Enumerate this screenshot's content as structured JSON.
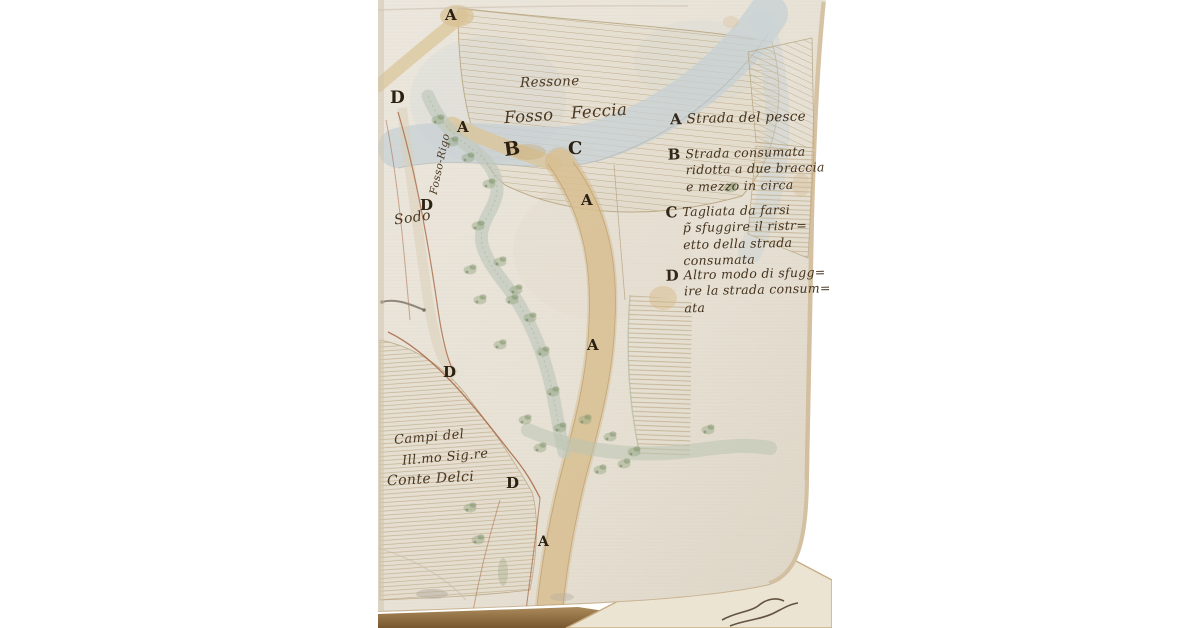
{
  "colors": {
    "background": "#ffffff",
    "paper": "#e8e2d8",
    "page_edge": "#c8aa7c",
    "ink": "#4a3722",
    "letter_ink": "#2b2112",
    "road_wash": "#d9c193",
    "stream_wash": "#c7d0d4",
    "vegetation_green": "#8ea37b",
    "boundary_red": "#a5603c"
  },
  "map_letters": [
    {
      "char": "A"
    },
    {
      "char": "D"
    },
    {
      "char": "A"
    },
    {
      "char": "B"
    },
    {
      "char": "C"
    },
    {
      "char": "A"
    },
    {
      "char": "D"
    },
    {
      "char": "A"
    },
    {
      "char": "D"
    },
    {
      "char": "D"
    },
    {
      "char": "A"
    }
  ],
  "place_names": {
    "ridge": "Ressone",
    "stream_main": "Fosso Feccia",
    "stream_side": "Fosso-Rigo",
    "sodo": "Sodo",
    "fields_owner_line1": "Campi del",
    "fields_owner_line2": "Ill.mo Sig.re",
    "fields_owner_line3": "Conte Delci"
  },
  "legend": {
    "items": [
      {
        "key": "A",
        "lines": [
          "Strada del pesce"
        ]
      },
      {
        "key": "B",
        "lines": [
          "Strada consumata",
          "ridotta a due braccia",
          "e mezzo in circa"
        ]
      },
      {
        "key": "C",
        "lines": [
          "Tagliata da farsi",
          "p̃ sfuggire il ristr=",
          "etto della strada",
          "consumata"
        ]
      },
      {
        "key": "D",
        "lines": [
          "Altro modo di sfugg=",
          "ire la strada consum=",
          "ata"
        ]
      }
    ]
  }
}
